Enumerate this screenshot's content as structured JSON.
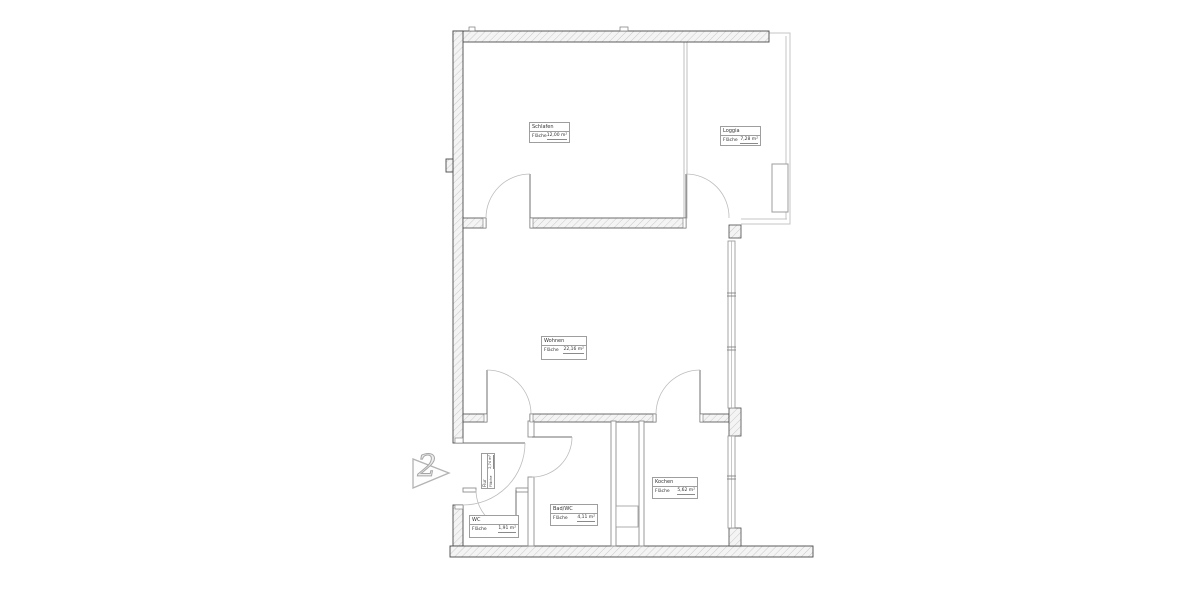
{
  "plan": {
    "unit_marker": "2",
    "area_label": "Fläche",
    "rooms": [
      {
        "id": "schlafen",
        "name": "Schlafen",
        "area": "12,00 m²"
      },
      {
        "id": "loggia",
        "name": "Loggia",
        "area": "7,28 m²"
      },
      {
        "id": "wohnen",
        "name": "Wohnen",
        "area": "22,16 m²"
      },
      {
        "id": "kochen",
        "name": "Kochen",
        "area": "5,62 m²"
      },
      {
        "id": "badwc",
        "name": "Bad/WC",
        "area": "4,11 m²"
      },
      {
        "id": "wc",
        "name": "WC",
        "area": "1,91 m²"
      },
      {
        "id": "flur",
        "name": "Flur",
        "area": "2,74 m²"
      }
    ],
    "colors": {
      "wall_outline": "#4a4a4a",
      "wall_hatch": "#c9c9c9",
      "wall_fill": "#f4f4f4",
      "thin_partition": "#8f8f8f",
      "loggia_line": "#c4c4c4",
      "door_arc": "#bdbdbd",
      "door_leaf": "#6f6f6f",
      "marker_outline": "#b3b3b3",
      "label_border": "#9e9e9e",
      "text": "#333333"
    }
  }
}
